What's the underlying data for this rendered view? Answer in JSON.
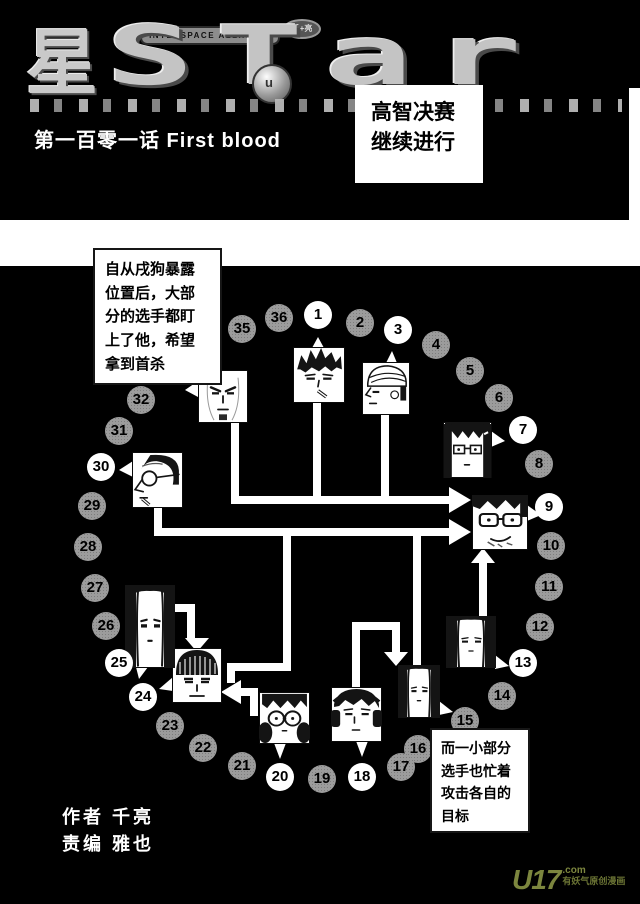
{
  "header": {
    "logo": {
      "kanji": "星",
      "latin": "STar",
      "banner": "INTERSPACE ALLIANCE",
      "badge": "千+亮",
      "emblem_glyph": "u"
    },
    "chapter_title": "第一百零一话 First blood",
    "caption_box": {
      "lines": [
        "高智决赛",
        "继续进行"
      ]
    }
  },
  "panel": {
    "narration_top_lines": [
      "自从戌狗暴露",
      "位置后，大部",
      "分的选手都盯",
      "上了他，希望",
      "拿到首杀"
    ],
    "narration_bottom_lines": [
      "而一小部分",
      "选手也忙着",
      "攻击各自的",
      "目标"
    ],
    "credits": [
      "作者 千亮",
      "责编 雅也"
    ]
  },
  "watermark": {
    "brand": "U17",
    "tld": ".com",
    "tagline": "有妖气原创漫画",
    "color": "#7c863e"
  },
  "diagram": {
    "colors": {
      "active_circle": "#ffffff",
      "inactive_circle": "#9c9c9c",
      "line": "#ffffff"
    },
    "numbers": [
      {
        "n": "1",
        "x": 318,
        "y": 315,
        "white": true
      },
      {
        "n": "2",
        "x": 360,
        "y": 323,
        "white": false
      },
      {
        "n": "3",
        "x": 398,
        "y": 330,
        "white": true
      },
      {
        "n": "4",
        "x": 436,
        "y": 345,
        "white": false
      },
      {
        "n": "5",
        "x": 470,
        "y": 371,
        "white": false
      },
      {
        "n": "6",
        "x": 499,
        "y": 398,
        "white": false
      },
      {
        "n": "7",
        "x": 523,
        "y": 430,
        "white": true
      },
      {
        "n": "8",
        "x": 539,
        "y": 464,
        "white": false
      },
      {
        "n": "9",
        "x": 549,
        "y": 507,
        "white": true
      },
      {
        "n": "10",
        "x": 551,
        "y": 546,
        "white": false
      },
      {
        "n": "11",
        "x": 549,
        "y": 587,
        "white": false
      },
      {
        "n": "12",
        "x": 540,
        "y": 627,
        "white": false
      },
      {
        "n": "13",
        "x": 523,
        "y": 663,
        "white": true
      },
      {
        "n": "14",
        "x": 502,
        "y": 696,
        "white": false
      },
      {
        "n": "15",
        "x": 465,
        "y": 721,
        "white": false
      },
      {
        "n": "16",
        "x": 418,
        "y": 749,
        "white": false
      },
      {
        "n": "17",
        "x": 401,
        "y": 767,
        "white": false
      },
      {
        "n": "18",
        "x": 362,
        "y": 777,
        "white": true
      },
      {
        "n": "19",
        "x": 322,
        "y": 779,
        "white": false
      },
      {
        "n": "20",
        "x": 280,
        "y": 777,
        "white": true
      },
      {
        "n": "21",
        "x": 242,
        "y": 766,
        "white": false
      },
      {
        "n": "22",
        "x": 203,
        "y": 748,
        "white": false
      },
      {
        "n": "23",
        "x": 170,
        "y": 726,
        "white": false
      },
      {
        "n": "24",
        "x": 143,
        "y": 697,
        "white": true
      },
      {
        "n": "25",
        "x": 119,
        "y": 663,
        "white": true
      },
      {
        "n": "26",
        "x": 106,
        "y": 626,
        "white": false
      },
      {
        "n": "27",
        "x": 95,
        "y": 588,
        "white": false
      },
      {
        "n": "28",
        "x": 88,
        "y": 547,
        "white": false
      },
      {
        "n": "29",
        "x": 92,
        "y": 506,
        "white": false
      },
      {
        "n": "30",
        "x": 101,
        "y": 467,
        "white": true
      },
      {
        "n": "31",
        "x": 119,
        "y": 431,
        "white": false
      },
      {
        "n": "32",
        "x": 141,
        "y": 400,
        "white": false
      },
      {
        "n": "35",
        "x": 242,
        "y": 329,
        "white": false
      },
      {
        "n": "36",
        "x": 279,
        "y": 318,
        "white": false
      }
    ],
    "portraits": [
      {
        "player": "34",
        "x": 198,
        "y": 370,
        "w": 50,
        "h": 53,
        "style": "bald"
      },
      {
        "player": "1",
        "x": 293,
        "y": 347,
        "w": 52,
        "h": 56,
        "style": "messy"
      },
      {
        "player": "3",
        "x": 362,
        "y": 362,
        "w": 48,
        "h": 53,
        "style": "turban"
      },
      {
        "player": "7",
        "x": 443,
        "y": 422,
        "w": 49,
        "h": 56,
        "style": "bangs"
      },
      {
        "player": "9",
        "x": 472,
        "y": 495,
        "w": 56,
        "h": 55,
        "style": "big"
      },
      {
        "player": "13",
        "x": 446,
        "y": 616,
        "w": 50,
        "h": 52,
        "style": "long"
      },
      {
        "player": "15",
        "x": 398,
        "y": 665,
        "w": 42,
        "h": 53,
        "style": "long"
      },
      {
        "player": "18",
        "x": 331,
        "y": 687,
        "w": 51,
        "h": 55,
        "style": "headphones"
      },
      {
        "player": "20",
        "x": 259,
        "y": 692,
        "w": 51,
        "h": 52,
        "style": "pigtails"
      },
      {
        "player": "24",
        "x": 172,
        "y": 648,
        "w": 50,
        "h": 55,
        "style": "bowl"
      },
      {
        "player": "25",
        "x": 125,
        "y": 585,
        "w": 50,
        "h": 83,
        "style": "long"
      },
      {
        "player": "30",
        "x": 132,
        "y": 452,
        "w": 51,
        "h": 56,
        "style": "old"
      }
    ],
    "lines": [
      {
        "x": 231,
        "y": 423,
        "w": 8,
        "h": 77
      },
      {
        "x": 313,
        "y": 403,
        "w": 8,
        "h": 97
      },
      {
        "x": 381,
        "y": 415,
        "w": 8,
        "h": 85
      },
      {
        "x": 231,
        "y": 496,
        "w": 218,
        "h": 8
      },
      {
        "x": 154,
        "y": 508,
        "w": 8,
        "h": 24
      },
      {
        "x": 154,
        "y": 528,
        "w": 295,
        "h": 8
      },
      {
        "x": 283,
        "y": 532,
        "w": 8,
        "h": 139
      },
      {
        "x": 227,
        "y": 663,
        "w": 64,
        "h": 8
      },
      {
        "x": 227,
        "y": 663,
        "w": 8,
        "h": 20
      },
      {
        "x": 241,
        "y": 688,
        "w": 17,
        "h": 8
      },
      {
        "x": 250,
        "y": 688,
        "w": 8,
        "h": 28
      },
      {
        "x": 413,
        "y": 532,
        "w": 8,
        "h": 133
      },
      {
        "x": 479,
        "y": 561,
        "w": 8,
        "h": 55
      },
      {
        "x": 352,
        "y": 630,
        "w": 8,
        "h": 57
      },
      {
        "x": 352,
        "y": 622,
        "w": 48,
        "h": 8
      },
      {
        "x": 392,
        "y": 630,
        "w": 8,
        "h": 24
      },
      {
        "x": 175,
        "y": 604,
        "w": 18,
        "h": 8
      },
      {
        "x": 187,
        "y": 604,
        "w": 8,
        "h": 36
      }
    ],
    "arrowheads": [
      "449,487 449,513 471,500",
      "449,519 449,545 471,532",
      "241,680 241,704 221,692",
      "471,563 495,563 483,548",
      "384,652 408,652 396,666",
      "185,638 209,638 197,652"
    ],
    "tails": [
      "198,381 198,397 185,390",
      "312,348 324,348 318,337",
      "386,363 397,363 392,351",
      "491,431 491,447 505,441",
      "527,505 527,521 541,515",
      "495,655 495,669 509,666",
      "439,701 439,715 453,712",
      "356,741 368,741 362,757",
      "274,743 286,743 280,759",
      "173,677 173,691 159,689",
      "136,667 148,667 139,679",
      "133,461 133,477 119,470"
    ]
  }
}
